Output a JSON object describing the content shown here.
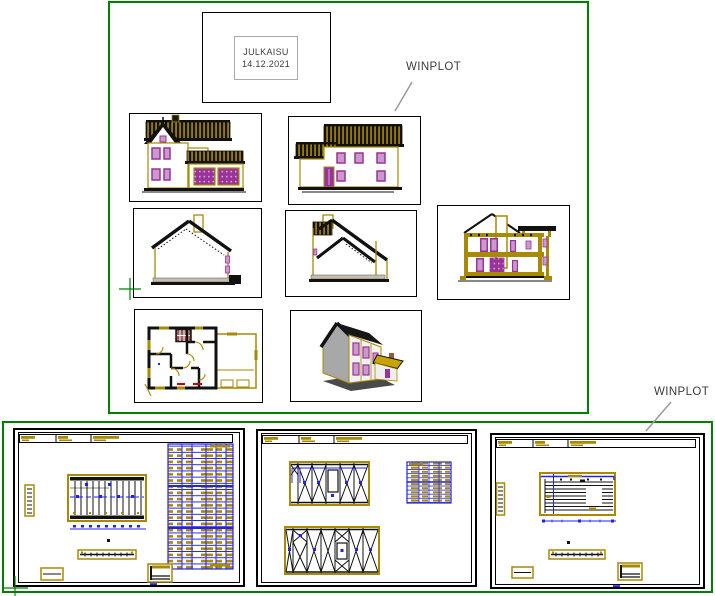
{
  "stamp": {
    "line1": "JULKAISU",
    "line2": "14.12.2021"
  },
  "labels": {
    "winplot_top": "WINPLOT",
    "winplot_bottom": "WINPLOT"
  },
  "colors": {
    "plot_frame_green": "#008000",
    "drawing_black": "#111111",
    "cad_olive": "#A88A00",
    "roof_stripe_olive": "#B89200",
    "window_purple": "#993399",
    "window_lilac": "#CC99CC",
    "table_blue": "#2222EE",
    "stair_maroon": "#9B5B5B",
    "mark_red": "#CC0000",
    "leader_gray": "#9A9A9A",
    "floor_tan": "#C6BDAF",
    "wall_gray_3d": "#A8A8A8",
    "label_text": "#3C3C3C",
    "stamp_border_gray": "#ABABAB"
  }
}
